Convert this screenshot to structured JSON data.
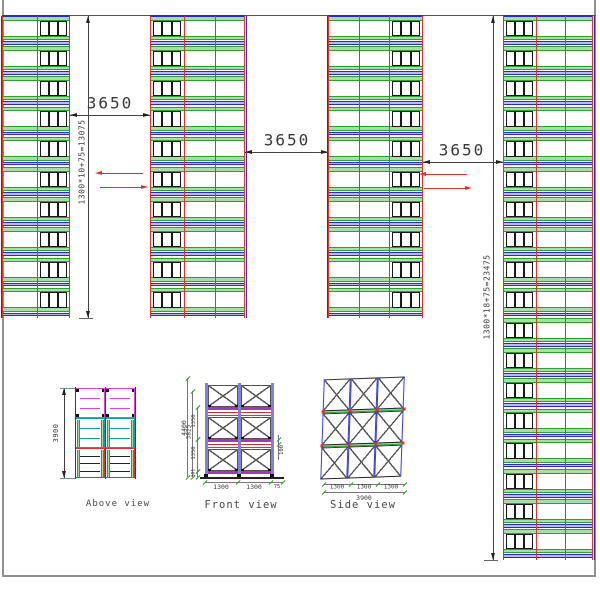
{
  "colors": {
    "red": "#e03030",
    "green_edge": "#2da02d",
    "green_fill": "#a8dca8",
    "blue": "#2a2ad0",
    "violet_fill": "#bcbcec",
    "magenta": "#dd44dd",
    "teal": "#18a099",
    "purple_beam": "#a832c8",
    "post_blue": "#8080e0",
    "dim": "#444444",
    "text": "#3a3a3a",
    "frame": "#8f8f8f",
    "black": "#1a1a1a"
  },
  "plan": {
    "top_line_y": 15,
    "module_pitch": 30.2,
    "strips": [
      {
        "x": 2,
        "y": 16,
        "modules": 10,
        "cols": [
          {
            "type": "lines",
            "w": 35
          },
          {
            "type": "pallets",
            "w": 33
          }
        ]
      },
      {
        "x": 150,
        "y": 16,
        "modules": 10,
        "cols": [
          {
            "type": "pallets",
            "w": 34
          },
          {
            "type": "lines",
            "w": 61,
            "mid": true
          }
        ]
      },
      {
        "x": 328,
        "y": 16,
        "modules": 10,
        "cols": [
          {
            "type": "lines",
            "w": 61,
            "mid": true
          },
          {
            "type": "pallets",
            "w": 34
          }
        ]
      },
      {
        "x": 503,
        "y": 16,
        "modules": 18,
        "cols": [
          {
            "type": "pallets",
            "w": 33
          },
          {
            "type": "lines",
            "w": 57,
            "mid": true
          }
        ]
      }
    ],
    "aisle_dims": [
      {
        "label": "3650",
        "x1": 70,
        "x2": 150,
        "y": 115,
        "tx": 110,
        "ty": 103
      },
      {
        "label": "3650",
        "x1": 245,
        "x2": 328,
        "y": 152,
        "tx": 287,
        "ty": 140
      },
      {
        "label": "3650",
        "x1": 423,
        "x2": 503,
        "y": 162,
        "tx": 462,
        "ty": 150
      }
    ],
    "vertical_dims": [
      {
        "label": "1300*10+75=13075",
        "x": 88,
        "y1": 16,
        "y2": 318,
        "tx": 82,
        "ty": 162
      },
      {
        "label": "1300*18+75=23475",
        "x": 493,
        "y1": 16,
        "y2": 560,
        "tx": 487,
        "ty": 297
      }
    ],
    "flow_arrows": [
      {
        "x1": 100,
        "x2": 143,
        "y": 173,
        "dir": "left"
      },
      {
        "x1": 100,
        "x2": 143,
        "y": 187,
        "dir": "right"
      },
      {
        "x1": 424,
        "x2": 467,
        "y": 174,
        "dir": "left"
      },
      {
        "x1": 424,
        "x2": 467,
        "y": 188,
        "dir": "right"
      }
    ]
  },
  "views": {
    "above": {
      "label": "Above view",
      "dim": {
        "label": "3900",
        "x": 64,
        "y1": 388,
        "y2": 478,
        "tx": 56,
        "ty": 433
      },
      "grid": {
        "x": 75,
        "y": 388,
        "bay_w": 30,
        "bays": 2,
        "row_h": 30,
        "rows": 3
      }
    },
    "front": {
      "label": "Front view",
      "posts_x": [
        205,
        238,
        271
      ],
      "post_top": 383,
      "ground_y": 477,
      "level_tops": [
        385,
        417,
        449
      ],
      "box_h": 22,
      "left_dims": [
        {
          "label": "4400",
          "x": 187,
          "y1": 378,
          "y2": 477,
          "ty": 428,
          "fs": 6.5
        },
        {
          "label": "3825",
          "x": 192,
          "y1": 391,
          "y2": 477,
          "ty": 432,
          "fs": 6
        },
        {
          "label": "1350",
          "x": 197,
          "y1": 407,
          "y2": 439,
          "ty": 421,
          "fs": 5.5
        },
        {
          "label": "1350",
          "x": 197,
          "y1": 439,
          "y2": 471,
          "ty": 453,
          "fs": 5.5
        },
        {
          "label": "381",
          "x": 197,
          "y1": 471,
          "y2": 477,
          "ty": 473,
          "fs": 4.5
        }
      ],
      "right_dim": {
        "label": "100",
        "x": 278,
        "y1": 435,
        "y2": 460,
        "ty": 450,
        "fs": 5.5
      },
      "bottom_dims": {
        "y": 482,
        "ty": 487,
        "ticks": [
          205,
          238,
          271,
          283
        ],
        "labels": [
          {
            "label": "1300",
            "tx": 221,
            "fs": 6.5
          },
          {
            "label": "1300",
            "tx": 254,
            "fs": 6.5
          },
          {
            "label": "75",
            "tx": 277,
            "fs": 5.5
          }
        ]
      }
    },
    "side": {
      "label": "Side view",
      "grid": {
        "x": 322,
        "y": 378,
        "cell_w": 27,
        "cols": 3,
        "cell_h": 31,
        "rows": 3
      },
      "bottom_dims": {
        "y": 484,
        "ty": 487,
        "ticks": [
          324,
          351,
          378,
          405
        ],
        "labels": [
          {
            "label": "1300",
            "tx": 337
          },
          {
            "label": "1300",
            "tx": 364
          },
          {
            "label": "1300",
            "tx": 391
          }
        ],
        "total": {
          "label": "3900",
          "y": 492,
          "x1": 324,
          "x2": 405,
          "tx": 364,
          "ty": 496
        }
      }
    }
  }
}
